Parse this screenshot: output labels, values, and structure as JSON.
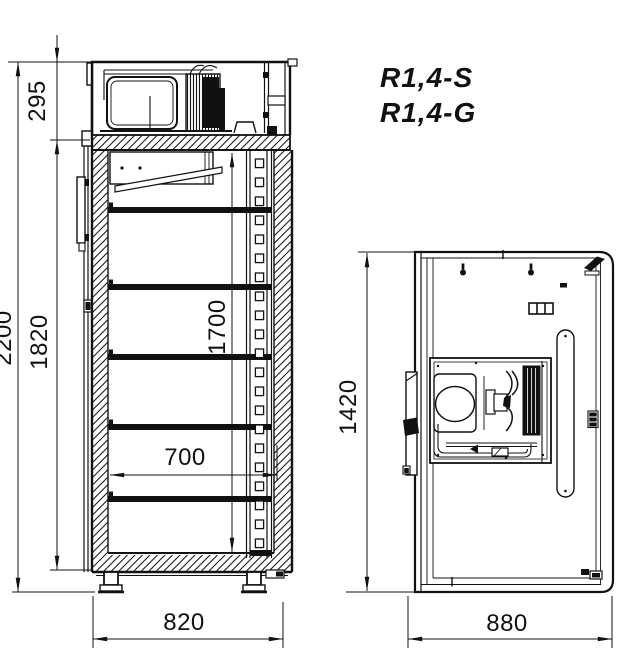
{
  "drawing": {
    "title": "Refrigerated cabinet technical drawing",
    "models": [
      "R1,4-S",
      "R1,4-G"
    ],
    "front_view": {
      "label": "front section view",
      "shelf_count": 5,
      "dimensions": {
        "overall_height": "2200",
        "body_height": "1820",
        "machine_compartment_height": "295",
        "interior_height": "1700",
        "interior_width": "700",
        "overall_width": "820"
      }
    },
    "top_view": {
      "label": "top view",
      "dimensions": {
        "depth": "1420",
        "width": "880"
      }
    },
    "colors": {
      "line": "#111111",
      "background": "#ffffff"
    }
  }
}
